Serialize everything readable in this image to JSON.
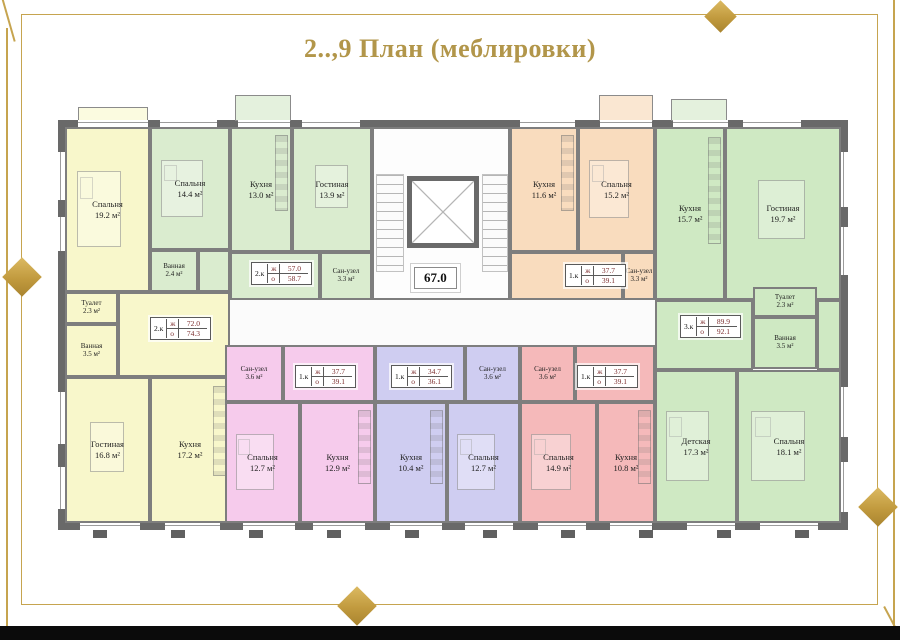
{
  "title": "2..,9 План (меблировки)",
  "corridor": {
    "area_label": "67.0"
  },
  "labels": {
    "living_key": "ж",
    "total_key": "о"
  },
  "theme": {
    "gold": "#c6a44f",
    "wall_gray": "#696969",
    "value_red": "#7b2b2b",
    "bottom_bar_black": "#0b0b0b"
  },
  "apartments": [
    {
      "id": "apt-2k-left",
      "type": "2.к",
      "living_area": "72.0",
      "total_area": "74.3",
      "color": "#f8f7cb",
      "rooms": [
        {
          "name": "Спальня",
          "area": "19.2 м²"
        },
        {
          "name": "Туалет",
          "area": "2.3 м²"
        },
        {
          "name": "Ванная",
          "area": "3.5 м²"
        },
        {
          "name": "Гостиная",
          "area": "16.8 м²"
        },
        {
          "name": "Кухня",
          "area": "17.2 м²"
        }
      ]
    },
    {
      "id": "apt-2k-top",
      "type": "2.к",
      "living_area": "57.0",
      "total_area": "58.7",
      "color": "#daeccf",
      "rooms": [
        {
          "name": "Спальня",
          "area": "14.4 м²"
        },
        {
          "name": "Ванная",
          "area": "2.4 м²"
        },
        {
          "name": "Кухня",
          "area": "13.0 м²"
        },
        {
          "name": "Гостиная",
          "area": "13.9 м²"
        },
        {
          "name": "Сан-узел",
          "area": "3.3 м²"
        }
      ]
    },
    {
      "id": "apt-1k-orange",
      "type": "1.к",
      "living_area": "37.7",
      "total_area": "39.1",
      "color": "#f9dcbe",
      "rooms": [
        {
          "name": "Кухня",
          "area": "11.6 м²"
        },
        {
          "name": "Спальня",
          "area": "15.2 м²"
        },
        {
          "name": "Сан-узел",
          "area": "3.3 м²"
        }
      ]
    },
    {
      "id": "apt-3k-right",
      "type": "3.к",
      "living_area": "89.9",
      "total_area": "92.1",
      "color": "#cfe9c3",
      "rooms": [
        {
          "name": "Кухня",
          "area": "15.7 м²"
        },
        {
          "name": "Гостиная",
          "area": "19.7 м²"
        },
        {
          "name": "Туалет",
          "area": "2.3 м²"
        },
        {
          "name": "Ванная",
          "area": "3.5 м²"
        },
        {
          "name": "Детская",
          "area": "17.3 м²"
        },
        {
          "name": "Спальня",
          "area": "18.1 м²"
        }
      ]
    },
    {
      "id": "apt-1k-pink",
      "type": "1.к",
      "living_area": "37.7",
      "total_area": "39.1",
      "color": "#f6cbec",
      "rooms": [
        {
          "name": "Сан-узел",
          "area": "3.6 м²"
        },
        {
          "name": "Спальня",
          "area": "12.7 м²"
        },
        {
          "name": "Кухня",
          "area": "12.9 м²"
        }
      ]
    },
    {
      "id": "apt-1k-purple",
      "type": "1.к",
      "living_area": "34.7",
      "total_area": "36.1",
      "color": "#cfcdf1",
      "rooms": [
        {
          "name": "Сан-узел",
          "area": "3.6 м²"
        },
        {
          "name": "Кухня",
          "area": "10.4 м²"
        },
        {
          "name": "Спальня",
          "area": "12.7 м²"
        }
      ]
    },
    {
      "id": "apt-1k-red",
      "type": "1.к",
      "living_area": "37.7",
      "total_area": "39.1",
      "color": "#f5b9ba",
      "rooms": [
        {
          "name": "Сан-узел",
          "area": "3.6 м²"
        },
        {
          "name": "Спальня",
          "area": "14.9 м²"
        },
        {
          "name": "Кухня",
          "area": "10.8 м²"
        }
      ]
    }
  ]
}
